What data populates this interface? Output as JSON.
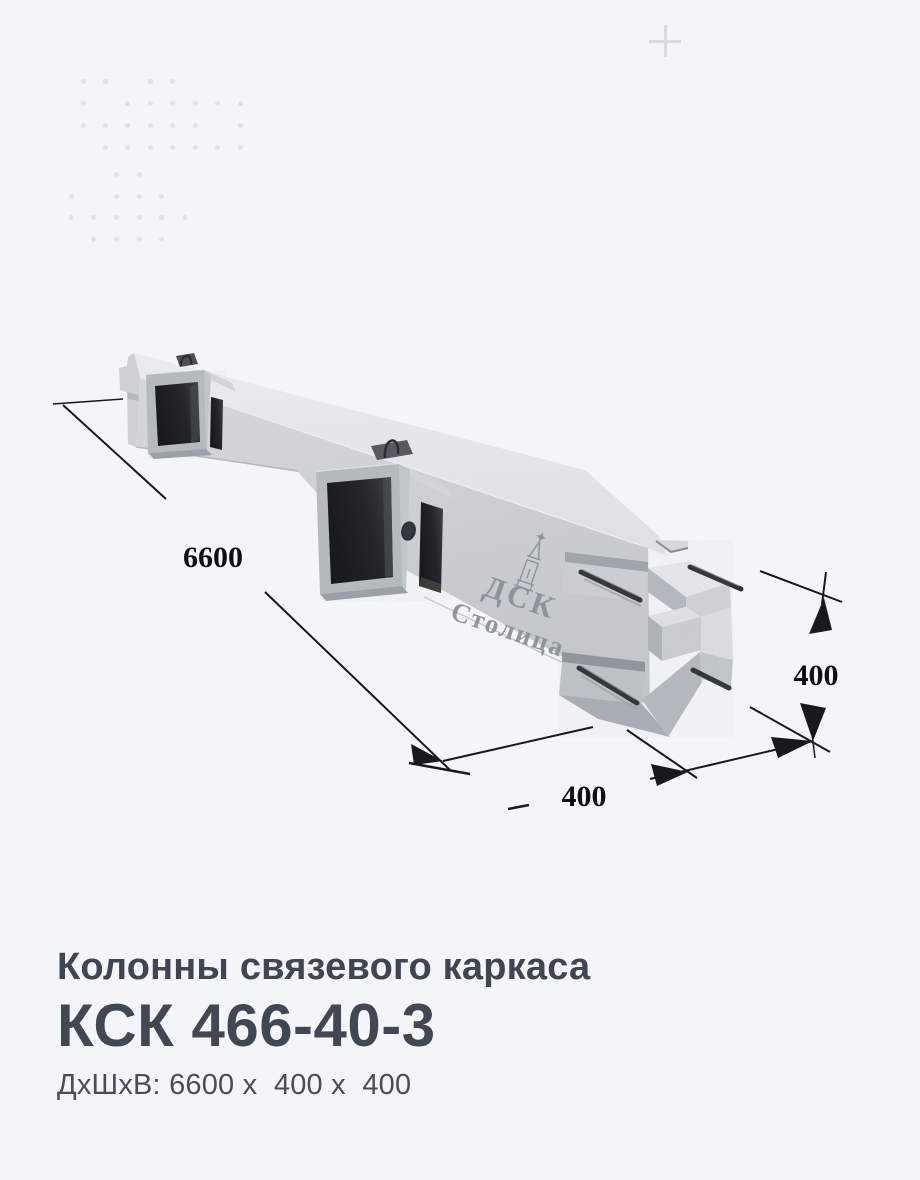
{
  "page": {
    "background_color": "#f4f5f8",
    "text_color": "#3f4551",
    "dimension_line_color": "#17191c"
  },
  "decor": {
    "plus_icon_color": "#d8dbdf",
    "dot_color": "#e0e2e7",
    "dot_rows": [
      {
        "y": 81,
        "xs": [
          83,
          105,
          150,
          172
        ]
      },
      {
        "y": 103,
        "xs": [
          83,
          127,
          150,
          172,
          195,
          217,
          240
        ]
      },
      {
        "y": 125,
        "xs": [
          83,
          105,
          127,
          150,
          172,
          195,
          240
        ]
      },
      {
        "y": 147,
        "xs": [
          105,
          127,
          150,
          172,
          195,
          217,
          240
        ]
      },
      {
        "y": 174,
        "xs": [
          116,
          139
        ]
      },
      {
        "y": 196,
        "xs": [
          71,
          116,
          139,
          161
        ]
      },
      {
        "y": 217,
        "xs": [
          71,
          93,
          116,
          139,
          161,
          184
        ]
      },
      {
        "y": 239,
        "xs": [
          93,
          116,
          139,
          161
        ]
      }
    ]
  },
  "drawing": {
    "length_label": "6600",
    "width_label": "400",
    "height_label": "400",
    "logo": {
      "brand_top": "ДСК",
      "brand_bottom": "Столица"
    }
  },
  "product": {
    "category": "Колонны связевого каркаса",
    "code": "КСК 466-40-3",
    "dimensions_line": "ДхШхВ: 6600 х  400 х  400"
  }
}
